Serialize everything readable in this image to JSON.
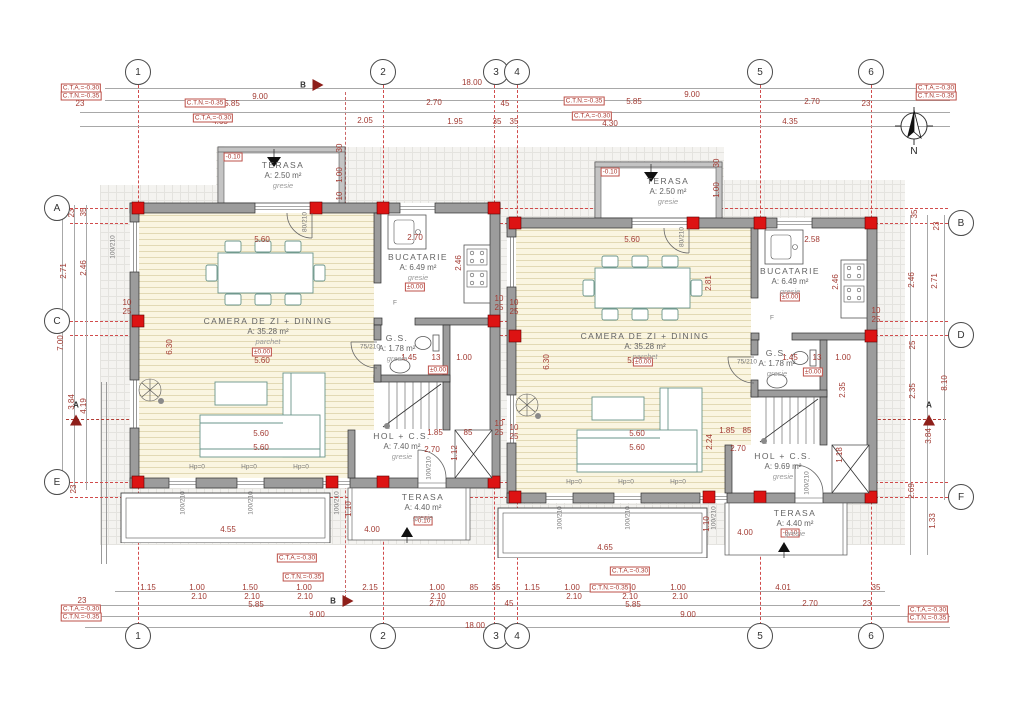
{
  "title": "Ground floor plan - duplex house",
  "north_label": "N",
  "sections": {
    "a": "A",
    "b": "B"
  },
  "colors": {
    "grid_red": "#d14b4b",
    "dim_red": "#a23a32",
    "column_red": "#dd1313",
    "wall_gray": "#9c9c9c",
    "wood_floor": "#faf5e1",
    "furniture": "#6a958b",
    "paving_bg": "#f4f3f0",
    "blue_axis": "#5b6fd0"
  },
  "grid_bubbles": [
    {
      "label": "1",
      "x": 138,
      "y": 72
    },
    {
      "label": "2",
      "x": 383,
      "y": 72
    },
    {
      "label": "3",
      "x": 496,
      "y": 72
    },
    {
      "label": "4",
      "x": 517,
      "y": 72
    },
    {
      "label": "5",
      "x": 760,
      "y": 72
    },
    {
      "label": "6",
      "x": 871,
      "y": 72
    },
    {
      "label": "1",
      "x": 138,
      "y": 636
    },
    {
      "label": "2",
      "x": 383,
      "y": 636
    },
    {
      "label": "3",
      "x": 496,
      "y": 636
    },
    {
      "label": "4",
      "x": 517,
      "y": 636
    },
    {
      "label": "5",
      "x": 760,
      "y": 636
    },
    {
      "label": "6",
      "x": 871,
      "y": 636
    },
    {
      "label": "A",
      "x": 57,
      "y": 208
    },
    {
      "label": "C",
      "x": 57,
      "y": 321
    },
    {
      "label": "E",
      "x": 57,
      "y": 482
    },
    {
      "label": "B",
      "x": 961,
      "y": 223
    },
    {
      "label": "D",
      "x": 961,
      "y": 335
    },
    {
      "label": "F",
      "x": 961,
      "y": 497
    }
  ],
  "rooms": [
    {
      "name": "TERASA",
      "area": "A: 2.50 m²",
      "floor": "gresie",
      "x": 283,
      "y": 160
    },
    {
      "name": "BUCATARIE",
      "area": "A: 6.49 m²",
      "floor": "gresie",
      "x": 418,
      "y": 252
    },
    {
      "name": "CAMERA DE ZI + DINING",
      "area": "A: 35.28 m²",
      "floor": "parchet",
      "x": 268,
      "y": 316
    },
    {
      "name": "G.S.",
      "area": "A: 1.78 m²",
      "floor": "gresie",
      "x": 397,
      "y": 333
    },
    {
      "name": "HOL + C.S.",
      "area": "A: 7.40 m²",
      "floor": "gresie",
      "x": 402,
      "y": 431
    },
    {
      "name": "TERASA",
      "area": "A: 4.40 m²",
      "floor": "gresie",
      "x": 423,
      "y": 492
    },
    {
      "name": "TERASA",
      "area": "A: 2.50 m²",
      "floor": "gresie",
      "x": 668,
      "y": 176
    },
    {
      "name": "BUCATARIE",
      "area": "A: 6.49 m²",
      "floor": "gresie",
      "x": 790,
      "y": 266
    },
    {
      "name": "CAMERA DE ZI + DINING",
      "area": "A: 35.28 m²",
      "floor": "parchet",
      "x": 645,
      "y": 331
    },
    {
      "name": "G.S.",
      "area": "A: 1.78 m²",
      "floor": "gresie",
      "x": 777,
      "y": 348
    },
    {
      "name": "HOL + C.S.",
      "area": "A: 9.69 m²",
      "floor": "gresie",
      "x": 783,
      "y": 451
    },
    {
      "name": "TERASA",
      "area": "A: 4.40 m²",
      "floor": "gresie",
      "x": 795,
      "y": 508
    }
  ],
  "boxed": [
    {
      "t": "C.T.A.=-0.30",
      "x": 81,
      "y": 88
    },
    {
      "t": "C.T.N.=-0.35",
      "x": 81,
      "y": 96
    },
    {
      "t": "C.T.A.=-0.30",
      "x": 936,
      "y": 88
    },
    {
      "t": "C.T.N.=-0.35",
      "x": 936,
      "y": 96
    },
    {
      "t": "C.T.A.=-0.30",
      "x": 81,
      "y": 609
    },
    {
      "t": "C.T.N.=-0.35",
      "x": 81,
      "y": 617
    },
    {
      "t": "C.T.A.=-0.30",
      "x": 928,
      "y": 610
    },
    {
      "t": "C.T.N.=-0.35",
      "x": 928,
      "y": 618
    },
    {
      "t": "C.T.N.=-0.35",
      "x": 205,
      "y": 103
    },
    {
      "t": "C.T.A.=-0.30",
      "x": 213,
      "y": 118
    },
    {
      "t": "C.T.N.=-0.35",
      "x": 584,
      "y": 101
    },
    {
      "t": "C.T.A.=-0.30",
      "x": 592,
      "y": 116
    },
    {
      "t": "C.T.A.=-0.30",
      "x": 297,
      "y": 558
    },
    {
      "t": "C.T.N.=-0.35",
      "x": 303,
      "y": 577
    },
    {
      "t": "C.T.A.=-0.30",
      "x": 630,
      "y": 571
    },
    {
      "t": "C.T.N.=-0.35",
      "x": 610,
      "y": 588
    },
    {
      "t": "-0.10",
      "x": 233,
      "y": 157
    },
    {
      "t": "-0.10",
      "x": 610,
      "y": 172
    },
    {
      "t": "-0.10",
      "x": 423,
      "y": 521
    },
    {
      "t": "-0.10",
      "x": 790,
      "y": 533
    },
    {
      "t": "±0.00",
      "x": 262,
      "y": 352
    },
    {
      "t": "±0.00",
      "x": 415,
      "y": 287
    },
    {
      "t": "±0.00",
      "x": 438,
      "y": 370
    },
    {
      "t": "±0.00",
      "x": 643,
      "y": 362
    },
    {
      "t": "±0.00",
      "x": 790,
      "y": 297
    },
    {
      "t": "±0.00",
      "x": 813,
      "y": 372
    }
  ],
  "dims": [
    {
      "t": "18.00",
      "x": 472,
      "y": 83
    },
    {
      "t": "9.00",
      "x": 260,
      "y": 97
    },
    {
      "t": "9.00",
      "x": 692,
      "y": 95
    },
    {
      "t": "23",
      "x": 80,
      "y": 104
    },
    {
      "t": "5.85",
      "x": 232,
      "y": 104
    },
    {
      "t": "2.70",
      "x": 434,
      "y": 103
    },
    {
      "t": "45",
      "x": 505,
      "y": 104
    },
    {
      "t": "5.85",
      "x": 634,
      "y": 102
    },
    {
      "t": "2.70",
      "x": 812,
      "y": 102
    },
    {
      "t": "23",
      "x": 866,
      "y": 104
    },
    {
      "t": "4.65",
      "x": 220,
      "y": 122
    },
    {
      "t": "2.05",
      "x": 365,
      "y": 121
    },
    {
      "t": "1.95",
      "x": 455,
      "y": 122
    },
    {
      "t": "35",
      "x": 497,
      "y": 122
    },
    {
      "t": "35",
      "x": 514,
      "y": 122
    },
    {
      "t": "4.30",
      "x": 610,
      "y": 124
    },
    {
      "t": "4.35",
      "x": 790,
      "y": 122
    },
    {
      "t": "1.15",
      "x": 148,
      "y": 588
    },
    {
      "t": "1.00",
      "x": 197,
      "y": 588
    },
    {
      "t": "1.50",
      "x": 250,
      "y": 588
    },
    {
      "t": "1.00",
      "x": 304,
      "y": 588
    },
    {
      "t": "2.15",
      "x": 370,
      "y": 588
    },
    {
      "t": "1.00",
      "x": 437,
      "y": 588
    },
    {
      "t": "85",
      "x": 474,
      "y": 588
    },
    {
      "t": "35",
      "x": 496,
      "y": 588
    },
    {
      "t": "2.10",
      "x": 199,
      "y": 597
    },
    {
      "t": "2.10",
      "x": 252,
      "y": 597
    },
    {
      "t": "2.10",
      "x": 305,
      "y": 597
    },
    {
      "t": "2.10",
      "x": 438,
      "y": 597
    },
    {
      "t": "23",
      "x": 82,
      "y": 601
    },
    {
      "t": "5.85",
      "x": 256,
      "y": 605
    },
    {
      "t": "2.70",
      "x": 437,
      "y": 604
    },
    {
      "t": "45",
      "x": 509,
      "y": 604
    },
    {
      "t": "9.00",
      "x": 317,
      "y": 615
    },
    {
      "t": "18.00",
      "x": 475,
      "y": 626
    },
    {
      "t": "1.15",
      "x": 532,
      "y": 588
    },
    {
      "t": "1.00",
      "x": 572,
      "y": 588
    },
    {
      "t": "1.50",
      "x": 628,
      "y": 588
    },
    {
      "t": "1.00",
      "x": 678,
      "y": 588
    },
    {
      "t": "4.01",
      "x": 783,
      "y": 588
    },
    {
      "t": "35",
      "x": 876,
      "y": 588
    },
    {
      "t": "2.10",
      "x": 574,
      "y": 597
    },
    {
      "t": "2.10",
      "x": 630,
      "y": 597
    },
    {
      "t": "2.10",
      "x": 680,
      "y": 597
    },
    {
      "t": "5.85",
      "x": 633,
      "y": 605
    },
    {
      "t": "2.70",
      "x": 810,
      "y": 604
    },
    {
      "t": "23",
      "x": 867,
      "y": 604
    },
    {
      "t": "9.00",
      "x": 688,
      "y": 615
    },
    {
      "t": "23",
      "x": 72,
      "y": 213,
      "r": -90
    },
    {
      "t": "35",
      "x": 84,
      "y": 212,
      "r": -90
    },
    {
      "t": "2.71",
      "x": 64,
      "y": 271,
      "r": -90
    },
    {
      "t": "2.46",
      "x": 84,
      "y": 268,
      "r": -90
    },
    {
      "t": "7.00",
      "x": 61,
      "y": 343,
      "r": -90
    },
    {
      "t": "3.84",
      "x": 72,
      "y": 402,
      "r": -90
    },
    {
      "t": "4.19",
      "x": 84,
      "y": 406,
      "r": -90
    },
    {
      "t": "23",
      "x": 74,
      "y": 489,
      "r": -90
    },
    {
      "t": "35",
      "x": 915,
      "y": 214,
      "r": -90
    },
    {
      "t": "23",
      "x": 937,
      "y": 226,
      "r": -90
    },
    {
      "t": "2.46",
      "x": 912,
      "y": 280,
      "r": -90
    },
    {
      "t": "2.71",
      "x": 935,
      "y": 281,
      "r": -90
    },
    {
      "t": "25",
      "x": 913,
      "y": 345,
      "r": -90
    },
    {
      "t": "8.10",
      "x": 945,
      "y": 383,
      "r": -90
    },
    {
      "t": "2.35",
      "x": 913,
      "y": 391,
      "r": -90
    },
    {
      "t": "3.84",
      "x": 929,
      "y": 436,
      "r": -90
    },
    {
      "t": "2.69",
      "x": 912,
      "y": 491,
      "r": -90
    },
    {
      "t": "1.33",
      "x": 933,
      "y": 521,
      "r": -90
    },
    {
      "t": "5.60",
      "x": 262,
      "y": 240
    },
    {
      "t": "2.70",
      "x": 415,
      "y": 238
    },
    {
      "t": "2.46",
      "x": 459,
      "y": 263,
      "r": -90
    },
    {
      "t": "80/210",
      "x": 305,
      "y": 222,
      "r": -90,
      "c": "g"
    },
    {
      "t": "6.30",
      "x": 170,
      "y": 347,
      "r": -90
    },
    {
      "t": "5.60",
      "x": 262,
      "y": 361
    },
    {
      "t": "75/210",
      "x": 370,
      "y": 347,
      "c": "g"
    },
    {
      "t": "1.45",
      "x": 409,
      "y": 358
    },
    {
      "t": "13",
      "x": 436,
      "y": 358
    },
    {
      "t": "1.00",
      "x": 464,
      "y": 358
    },
    {
      "t": "5.60",
      "x": 261,
      "y": 434
    },
    {
      "t": "5.60",
      "x": 261,
      "y": 448
    },
    {
      "t": "1.85",
      "x": 435,
      "y": 433
    },
    {
      "t": "85",
      "x": 468,
      "y": 433
    },
    {
      "t": "2.70",
      "x": 432,
      "y": 450
    },
    {
      "t": "1.12",
      "x": 455,
      "y": 453,
      "r": -90
    },
    {
      "t": "100/210",
      "x": 429,
      "y": 468,
      "r": -90,
      "c": "g"
    },
    {
      "t": "4.00",
      "x": 372,
      "y": 530
    },
    {
      "t": "4.55",
      "x": 228,
      "y": 530
    },
    {
      "t": "1.10",
      "x": 349,
      "y": 509,
      "r": -90
    },
    {
      "t": "30",
      "x": 340,
      "y": 148,
      "r": -90
    },
    {
      "t": "1.00",
      "x": 340,
      "y": 175,
      "r": -90
    },
    {
      "t": "10",
      "x": 340,
      "y": 196,
      "r": -90
    },
    {
      "t": "100/210",
      "x": 113,
      "y": 247,
      "r": -90,
      "c": "g"
    },
    {
      "t": "F",
      "x": 395,
      "y": 303,
      "c": "g"
    },
    {
      "t": "Hp=0",
      "x": 197,
      "y": 467,
      "c": "g"
    },
    {
      "t": "Hp=0",
      "x": 249,
      "y": 467,
      "c": "g"
    },
    {
      "t": "Hp=0",
      "x": 301,
      "y": 467,
      "c": "g"
    },
    {
      "t": "100/210",
      "x": 183,
      "y": 503,
      "r": -90,
      "c": "g"
    },
    {
      "t": "100/210",
      "x": 251,
      "y": 503,
      "r": -90,
      "c": "g"
    },
    {
      "t": "100/210",
      "x": 337,
      "y": 503,
      "r": -90,
      "c": "g"
    },
    {
      "t": "10",
      "x": 127,
      "y": 303
    },
    {
      "t": "25",
      "x": 127,
      "y": 312
    },
    {
      "t": "10",
      "x": 499,
      "y": 299
    },
    {
      "t": "25",
      "x": 499,
      "y": 308
    },
    {
      "t": "10",
      "x": 514,
      "y": 303
    },
    {
      "t": "25",
      "x": 514,
      "y": 312
    },
    {
      "t": "10",
      "x": 499,
      "y": 424
    },
    {
      "t": "25",
      "x": 499,
      "y": 433
    },
    {
      "t": "10",
      "x": 514,
      "y": 428
    },
    {
      "t": "25",
      "x": 514,
      "y": 437
    },
    {
      "t": "5.60",
      "x": 632,
      "y": 240
    },
    {
      "t": "2.58",
      "x": 812,
      "y": 240
    },
    {
      "t": "2.46",
      "x": 836,
      "y": 282,
      "r": -90
    },
    {
      "t": "80/210",
      "x": 682,
      "y": 237,
      "r": -90,
      "c": "g"
    },
    {
      "t": "6.30",
      "x": 547,
      "y": 362,
      "r": -90
    },
    {
      "t": "2.81",
      "x": 709,
      "y": 283,
      "r": -90
    },
    {
      "t": "5.60",
      "x": 635,
      "y": 361
    },
    {
      "t": "75/210",
      "x": 747,
      "y": 362,
      "c": "g"
    },
    {
      "t": "1.45",
      "x": 790,
      "y": 358
    },
    {
      "t": "13",
      "x": 817,
      "y": 358
    },
    {
      "t": "1.00",
      "x": 843,
      "y": 358
    },
    {
      "t": "2.35",
      "x": 843,
      "y": 390,
      "r": -90
    },
    {
      "t": "5.60",
      "x": 637,
      "y": 434
    },
    {
      "t": "5.60",
      "x": 637,
      "y": 448
    },
    {
      "t": "2.24",
      "x": 710,
      "y": 442,
      "r": -90
    },
    {
      "t": "1.85",
      "x": 727,
      "y": 431
    },
    {
      "t": "85",
      "x": 747,
      "y": 431
    },
    {
      "t": "2.70",
      "x": 738,
      "y": 449
    },
    {
      "t": "1.18",
      "x": 840,
      "y": 455,
      "r": -90
    },
    {
      "t": "100/210",
      "x": 807,
      "y": 483,
      "r": -90,
      "c": "g"
    },
    {
      "t": "4.00",
      "x": 745,
      "y": 533
    },
    {
      "t": "4.65",
      "x": 605,
      "y": 548
    },
    {
      "t": "1.10",
      "x": 707,
      "y": 524,
      "r": -90
    },
    {
      "t": "30",
      "x": 717,
      "y": 163,
      "r": -90
    },
    {
      "t": "1.00",
      "x": 717,
      "y": 190,
      "r": -90
    },
    {
      "t": "F",
      "x": 772,
      "y": 318,
      "c": "g"
    },
    {
      "t": "Hp=0",
      "x": 574,
      "y": 482,
      "c": "g"
    },
    {
      "t": "Hp=0",
      "x": 626,
      "y": 482,
      "c": "g"
    },
    {
      "t": "Hp=0",
      "x": 678,
      "y": 482,
      "c": "g"
    },
    {
      "t": "100/210",
      "x": 560,
      "y": 518,
      "r": -90,
      "c": "g"
    },
    {
      "t": "100/210",
      "x": 628,
      "y": 518,
      "r": -90,
      "c": "g"
    },
    {
      "t": "100/210",
      "x": 714,
      "y": 518,
      "r": -90,
      "c": "g"
    },
    {
      "t": "10",
      "x": 876,
      "y": 311
    },
    {
      "t": "25",
      "x": 876,
      "y": 320
    }
  ]
}
